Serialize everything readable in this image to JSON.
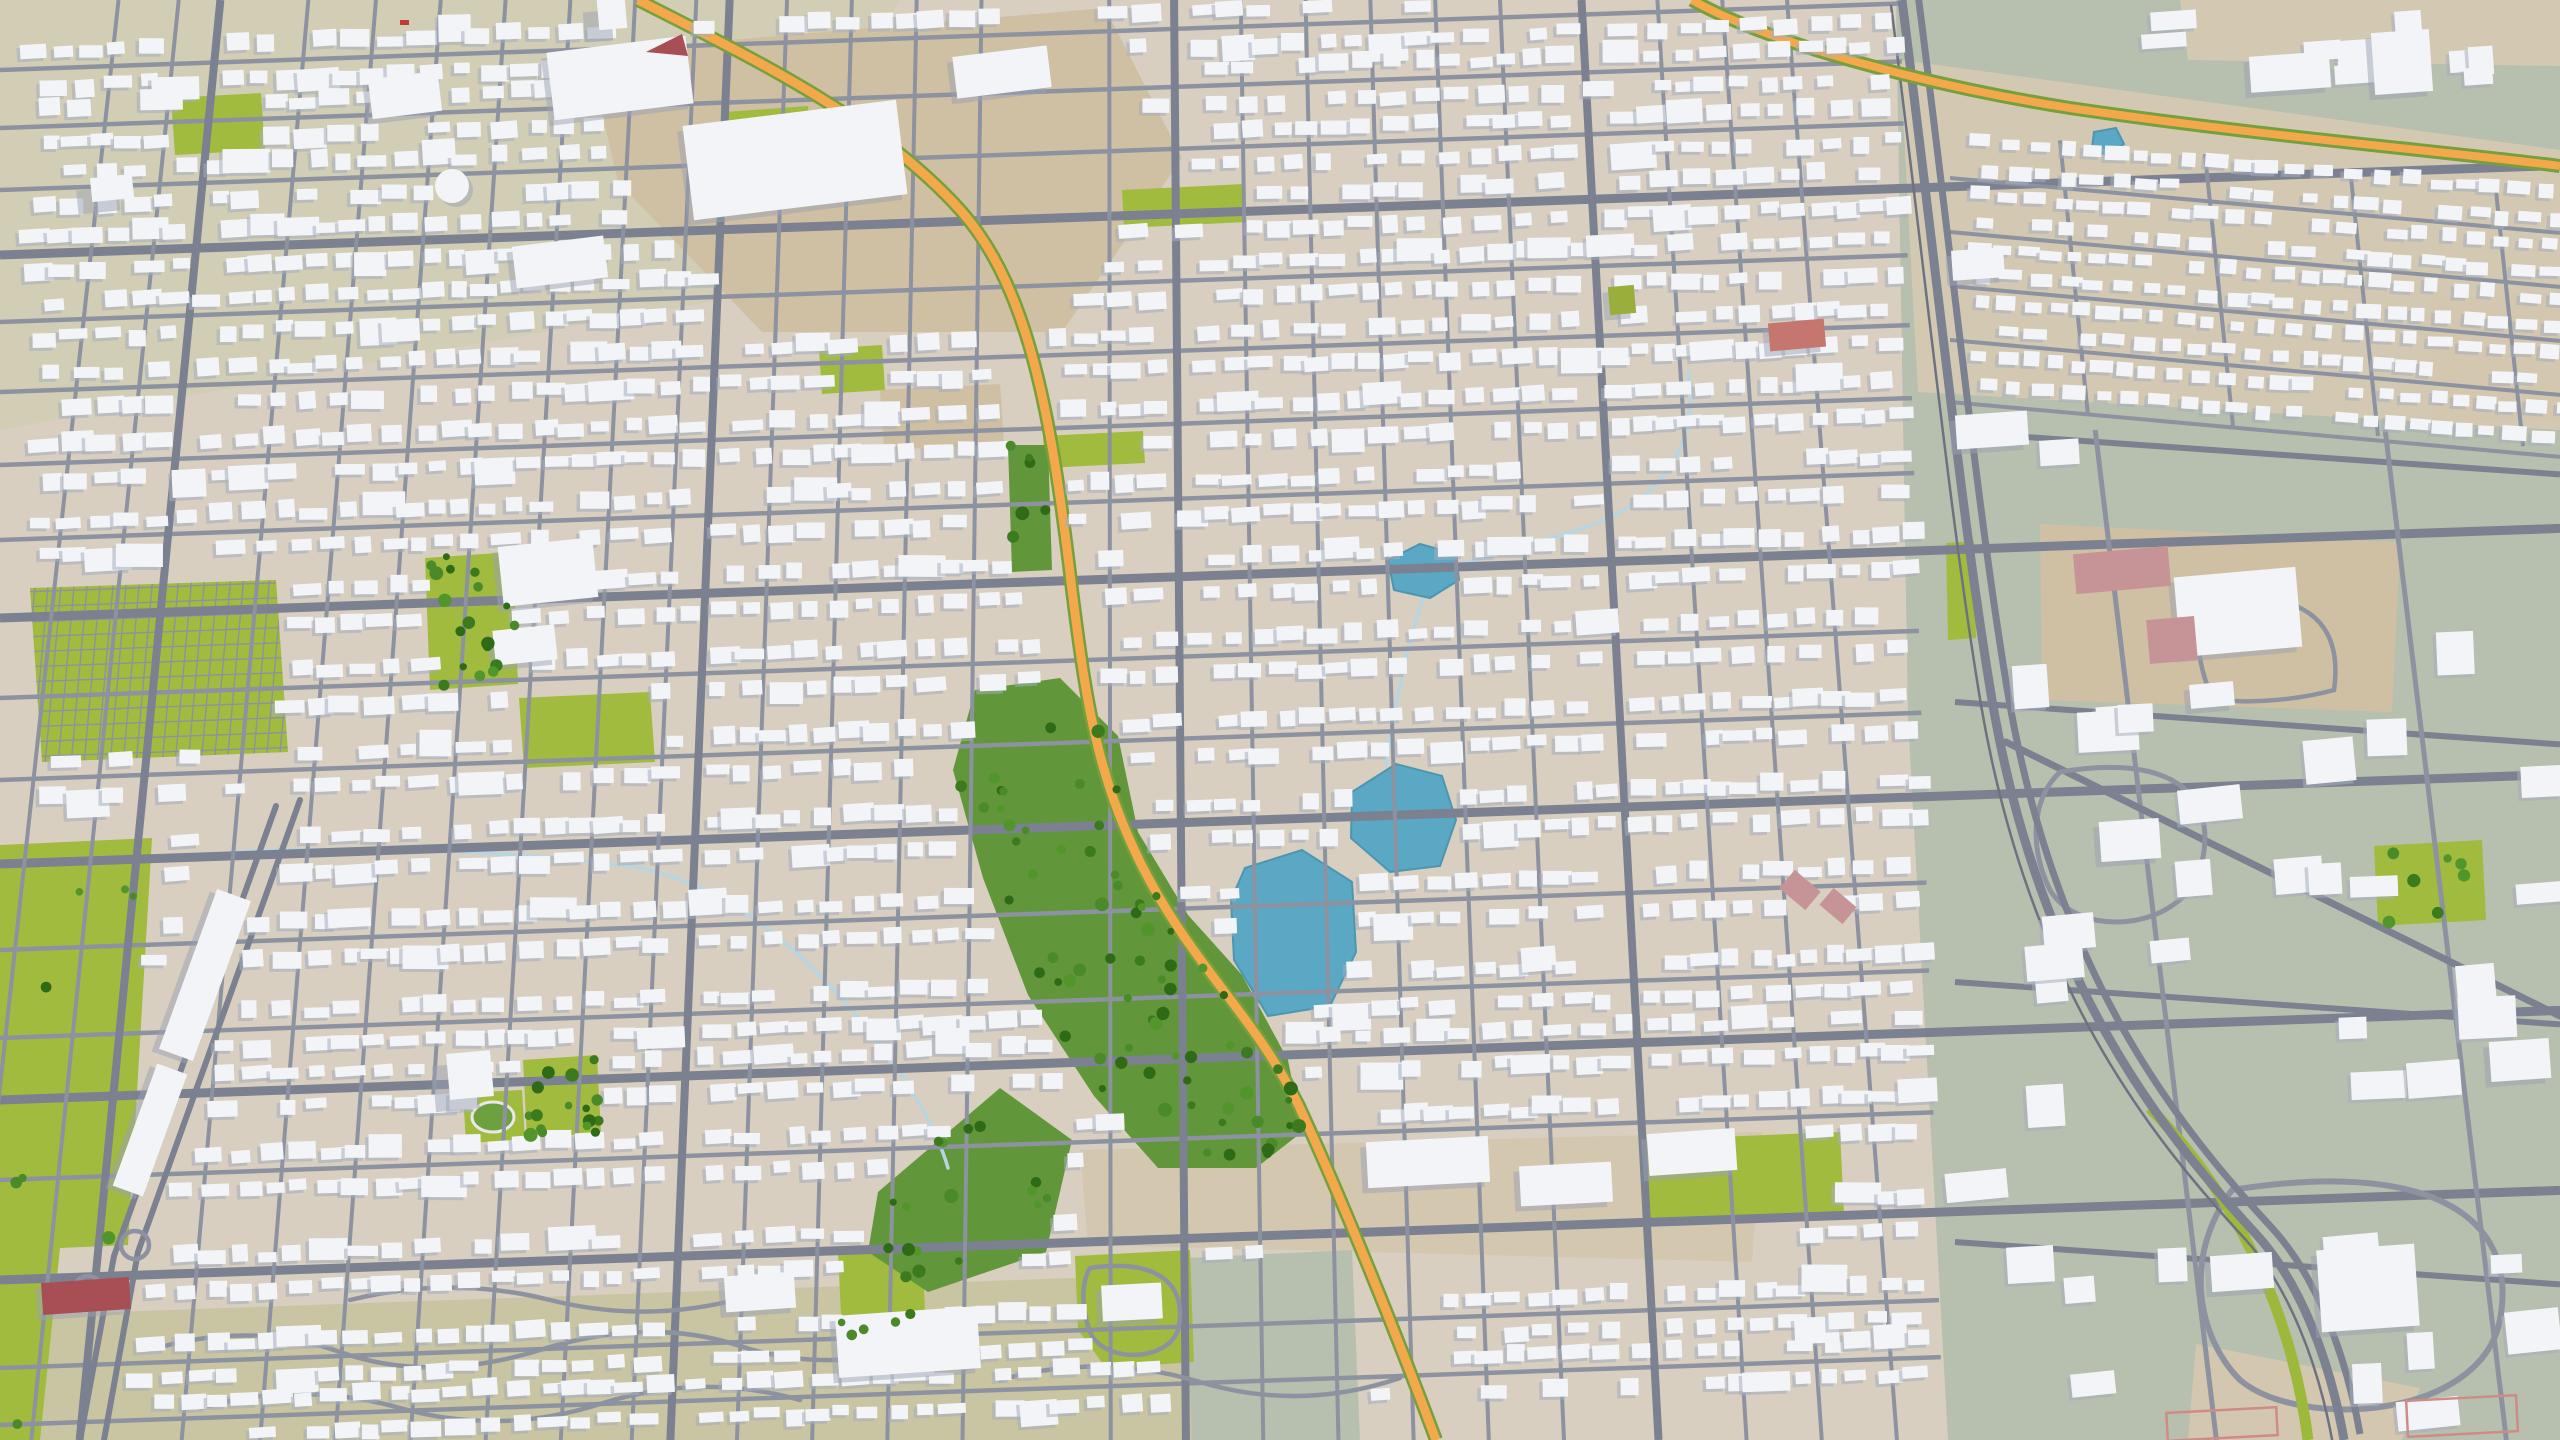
{
  "meta": {
    "description": "Aerial tilted 3D render of a suburban city map: dense white low-poly buildings on tan ground, gray street grid, orange highways, green parks, a central tree-lined greenbelt, blue lakes, and a sage-green open district on the right"
  },
  "palette": {
    "ground": "#d8cfc1",
    "olive_tl": "#d2ceb5",
    "khaki_bottom": "#c9c5a2",
    "dirt": "#cfc0a3",
    "dirt_light": "#d3c7b0",
    "sage": "#b7c0ae",
    "band_tan": "#d3c9b3",
    "lawn": "#a0bb3e",
    "grass_dark": "#61973a",
    "grass_mid": "#6fa03f",
    "lake": "#5aa8c4",
    "lake_edge": "#4d96b1",
    "stream": "#b7d6e2",
    "road_minor": "#8d92a0",
    "road_major": "#7b8190",
    "rail": "#6d7280",
    "highway": "#f3a94b",
    "highway_verge": "#75a03c",
    "median_green": "#9db93c",
    "house_top": "#f2f4f8",
    "house_shadow": "#a6adbb",
    "landmark_shadow": "#9ba2b2",
    "track_lane": "#e8e8ea",
    "red_building": "#a84f56",
    "salmon_building": "#c4766f",
    "olive_building": "#9aae3c",
    "pink_field": "#c69497",
    "pink_outline": "#cf8b85",
    "red_vehicle": "#c23b31"
  },
  "gen": {
    "seed": 7,
    "canvas": {
      "w": 2560,
      "h": 1440
    },
    "vp": {
      "x": 1100,
      "y": -9000
    },
    "ew_slope": -0.035,
    "xend_base": 1898,
    "xend_k": 0.03,
    "house": {
      "step_min": 22,
      "step_rand": 15,
      "w_min": 15,
      "w_rand": 16,
      "h_min": 10,
      "h_rand": 8,
      "off_min": 8,
      "off_rand": 5,
      "big_chance": 0.06,
      "skip_chance": 0.09,
      "rot_base": -2,
      "rot_jitter": 5
    },
    "sage_boxes": {
      "n": 46,
      "x0": 1975,
      "xr": 575,
      "y0": 430,
      "yr": 1000,
      "w_min": 26,
      "w_rand": 42,
      "h_min": 18,
      "h_rand": 26
    },
    "corner_boxes": {
      "n": 9,
      "x0": 2160,
      "xr": 370,
      "y0": 8,
      "yr": 80,
      "w_min": 20,
      "w_rand": 30,
      "h_min": 14,
      "h_rand": 16
    }
  },
  "ground_patches": [
    {
      "name": "olive-top-left",
      "points": "0,0 900,0 720,300 0,430",
      "fill": "olive_tl"
    },
    {
      "name": "khaki-bottom",
      "points": "0,1316 1298,1270 1340,1440 0,1440",
      "fill": "khaki_bottom"
    },
    {
      "name": "sage-district",
      "points": "1896,0 2560,0 2560,1440 1948,1440 1908,720",
      "fill": "sage"
    },
    {
      "name": "tan-band-top-right",
      "points": "1900,60 2560,150 2560,430 1918,392",
      "fill": "band_tan"
    },
    {
      "name": "tan-corner-top-right",
      "points": "2180,0 2560,0 2560,66 2188,60",
      "fill": "band_tan"
    },
    {
      "name": "dirt-industrial-top",
      "points": "588,52 1105,8 1182,158 1062,332 762,332 618,182",
      "fill": "dirt"
    },
    {
      "name": "dirt-campus-right",
      "points": "2040,524 2400,542 2392,712 2042,700",
      "fill": "dirt"
    },
    {
      "name": "dirt-commercial-bottom-center",
      "points": "1080,1150 1762,1132 1752,1262 1285,1250 1088,1245",
      "fill": "dirt_light"
    },
    {
      "name": "dirt-patch-center",
      "points": "880,390 1000,384 1004,444 884,450",
      "fill": "dirt"
    },
    {
      "name": "dirt-bottom-right",
      "points": "2196,1344 2420,1388 2402,1440 2188,1440",
      "fill": "dirt_light"
    },
    {
      "name": "dirt-right-edge",
      "points": "2428,298 2560,292 2560,420 2432,422",
      "fill": "dirt_light"
    },
    {
      "name": "sage-patch-bottom-center",
      "points": "1185,1258 1352,1250 1360,1440 1192,1440",
      "fill": "sage"
    }
  ],
  "parks": [
    {
      "name": "park-small-tl",
      "points": "171,98 261,93 265,150 175,155",
      "mask": true
    },
    {
      "name": "park-top-1",
      "points": "725,112 808,106 812,178 729,184",
      "mask": true
    },
    {
      "name": "park-top-2",
      "points": "1122,190 1244,184 1246,222 1124,228",
      "mask": true
    },
    {
      "name": "park-top-3",
      "points": "819,349 882,345 885,390 822,394",
      "mask": true
    },
    {
      "name": "park-trees-left",
      "points": "425,558 513,552 518,684 430,690",
      "mask": true
    },
    {
      "name": "lawns-bottom-left",
      "points": "0,845 152,838 128,1245 60,1248 40,1440 0,1440",
      "mask": true
    },
    {
      "name": "hospital-lawn",
      "points": "519,698 650,692 655,762 524,768",
      "mask": true
    },
    {
      "name": "park-bc-a",
      "points": "838,1252 922,1248 926,1332 842,1336",
      "mask": true
    },
    {
      "name": "park-bc-b",
      "points": "1075,1256 1190,1250 1194,1362 1106,1368 1078,1330",
      "mask": true
    },
    {
      "name": "lawn-big-building",
      "points": "1646,1140 1840,1132 1844,1212 1650,1220",
      "mask": true
    },
    {
      "name": "green-right-side",
      "points": "2374,846 2482,840 2486,920 2378,926",
      "mask": true
    },
    {
      "name": "park-strip-center",
      "points": "1043,436 1143,431 1145,463 1045,468",
      "mask": true
    },
    {
      "name": "park-trees-bl",
      "points": "523,1060 597,1055 601,1133 527,1138",
      "mask": true
    },
    {
      "name": "track-park",
      "points": "463,1093 522,1090 525,1140 466,1143",
      "mask": true
    },
    {
      "name": "corridor-verge",
      "points": "1946,543 1974,541 1976,638 1948,640",
      "mask": false
    }
  ],
  "greenbelt": [
    {
      "name": "greenbelt-main",
      "points": "975,690 1060,678 1118,736 1138,832 1188,915 1242,975 1288,1060 1302,1132 1256,1168 1158,1168 1094,1096 1028,995 983,878 953,770",
      "mask": true
    },
    {
      "name": "greenbelt-southwest",
      "points": "878,1192 1000,1088 1072,1140 1046,1252 928,1292 868,1252",
      "mask": true
    },
    {
      "name": "greenbelt-north-strip",
      "points": "1008,445 1048,445 1052,570 1012,572",
      "mask": true
    }
  ],
  "cemetery": {
    "name": "cemetery-grid-park",
    "points": "30,588 276,580 288,752 42,762",
    "mask": true
  },
  "lakes": [
    {
      "name": "lake-large",
      "points": "1245,868 1302,850 1352,882 1356,952 1330,1006 1268,1016 1234,960 1231,900",
      "mask": true
    },
    {
      "name": "lake-upper",
      "points": "1352,792 1396,764 1442,776 1456,820 1440,866 1390,872 1351,838",
      "mask": true
    },
    {
      "name": "lake-small-north",
      "points": "1388,560 1420,544 1456,554 1459,580 1430,598 1394,590",
      "mask": true
    },
    {
      "name": "pond-top-right",
      "points": "2094,132 2116,128 2124,144 2108,156 2092,148",
      "mask": false
    }
  ],
  "streams": [
    {
      "name": "creek-west",
      "d": "M230,852 C360,846 520,850 640,868 C760,892 850,1000 905,1080 C925,1112 940,1140 948,1168"
    },
    {
      "name": "creek-northeast",
      "d": "M1688,372 C1700,430 1672,492 1600,522 C1550,540 1490,556 1452,566"
    },
    {
      "name": "creek-lake-link",
      "d": "M1424,596 C1408,640 1396,700 1386,764"
    }
  ],
  "masks_extra": [
    {
      "name": "highway-corridor-band",
      "points": "618,0 702,42 962,198 1042,322 1082,560 1112,722 1172,880 1262,1020 1342,1152 1442,1332 1500,1440 1418,1440 1268,1162 1178,982 1078,800 1040,622 998,382 918,242 658,62 578,0"
    },
    {
      "name": "boulevard-band",
      "points": "292,798 222,796 70,1238 18,1440 122,1440 164,1240"
    }
  ],
  "roads": {
    "ew_minor_y": [
      70,
      128,
      190,
      322,
      392,
      465,
      540,
      698,
      780,
      950,
      1038,
      1180,
      1368,
      1425
    ],
    "ew_major_y": [
      255,
      618,
      864,
      1100,
      1280
    ],
    "ns_minor_x": [
      40,
      105,
      245,
      318,
      388,
      458,
      528,
      598,
      664,
      762,
      832,
      902,
      972,
      1110,
      1252,
      1322,
      1392,
      1462,
      1532,
      1702,
      1772,
      1842
    ],
    "ns_major_x": [
      150,
      700,
      1180,
      1620
    ],
    "sage_ew_y": [
      432,
      702,
      982,
      1242
    ],
    "sage_ew_slope": 0.07,
    "band_ew_y": [
      178,
      232,
      286,
      340,
      402
    ],
    "band_ew_slope": 0.09,
    "band_ns_x": [
      2060,
      2205,
      2350,
      2495
    ],
    "house_rows_y": [
      70,
      128,
      190,
      255,
      322,
      392,
      465,
      540,
      618,
      698,
      780,
      864,
      950,
      1038,
      1100,
      1180,
      1280,
      1368,
      1425
    ],
    "band_house_rows_y": [
      152,
      205,
      258,
      312,
      368
    ],
    "explicit": [
      {
        "name": "boulevard-lane-1",
        "d": "M300,800 L138,1252 L104,1440",
        "stroke": "road_major",
        "w": 6
      },
      {
        "name": "boulevard-lane-2",
        "d": "M276,806 L114,1256 L80,1440",
        "stroke": "road_major",
        "w": 6
      },
      {
        "name": "sage-diagonal-road",
        "d": "M2006,742 L2560,1016",
        "stroke": "road_major",
        "w": 7
      },
      {
        "name": "sage-loop-mall",
        "d": "M2232,1190 C2420,1160 2520,1210 2500,1320 C2480,1420 2300,1430 2240,1380 C2200,1340 2180,1260 2232,1190",
        "stroke": "road_minor",
        "w": 6
      },
      {
        "name": "sage-loop-mid",
        "d": "M2060,772 C2180,752 2220,800 2200,870 C2180,930 2080,940 2050,890 C2030,850 2030,800 2060,772",
        "stroke": "road_minor",
        "w": 5
      },
      {
        "name": "campus-loop",
        "d": "M2210,600 C2300,588 2344,618 2334,690 C2290,702 2236,704 2212,698 C2196,660 2192,618 2210,600",
        "stroke": "road_minor",
        "w": 4.5
      },
      {
        "name": "curvy-bottom-1",
        "d": "M150,1350 Q250,1320 340,1352 T540,1350 T740,1346 T940,1342",
        "stroke": "road_minor",
        "w": 4.5
      },
      {
        "name": "curvy-bottom-2",
        "d": "M200,1408 Q300,1380 400,1408 T600,1404 T800,1400",
        "stroke": "road_minor",
        "w": 4.5
      },
      {
        "name": "curvy-bottom-3",
        "d": "M1000,1380 Q1100,1352 1200,1382 T1400,1378",
        "stroke": "road_minor",
        "w": 4.5
      },
      {
        "name": "curvy-bottom-4",
        "d": "M350,1300 Q450,1275 550,1300 T750,1296",
        "stroke": "road_minor",
        "w": 4.5
      },
      {
        "name": "park-bc-loop",
        "d": "M1090,1268 C1160,1258 1188,1286 1178,1330 C1168,1360 1110,1364 1092,1336 C1082,1314 1080,1284 1090,1268",
        "stroke": "road_minor",
        "w": 4.5
      }
    ],
    "interchange_circles": [
      {
        "name": "ramp-loop-1",
        "cx": 88,
        "cy": 1290,
        "r": 14
      },
      {
        "name": "ramp-loop-2",
        "cx": 135,
        "cy": 1245,
        "r": 14
      }
    ]
  },
  "corridor": {
    "main_d": "M1902,0 C1940,300 1962,520 1992,700 C2040,980 2160,1130 2256,1234 C2300,1282 2330,1360 2344,1440",
    "pts": "1902,0 1992,700 2256,1234 2344,1440",
    "median_d": "M2150,1108 C2230,1190 2290,1300 2308,1440"
  },
  "highways": {
    "main": {
      "name": "highway-main",
      "d": "M638,0 C760,62 880,120 962,212 C1030,290 1052,420 1072,590 C1086,700 1096,772 1140,862 C1192,966 1252,1012 1298,1104 C1338,1190 1392,1322 1436,1440"
    },
    "top_right": {
      "name": "highway-top-right",
      "d": "M1692,0 C1770,44 1930,86 2070,108 C2260,136 2452,152 2560,166",
      "pts": "1692,0 2070,108 2560,166"
    }
  },
  "landmarks": [
    {
      "name": "factory-1",
      "x": 620,
      "y": 78,
      "w": 140,
      "h": 68,
      "r": -7
    },
    {
      "name": "factory-large",
      "x": 795,
      "y": 160,
      "w": 215,
      "h": 95,
      "r": -7
    },
    {
      "name": "factory-2",
      "x": 1002,
      "y": 72,
      "w": 95,
      "h": 42,
      "r": -7
    },
    {
      "name": "warehouse-top",
      "x": 560,
      "y": 262,
      "w": 92,
      "h": 42,
      "r": -7
    },
    {
      "name": "bigbox-top-left",
      "x": 405,
      "y": 95,
      "w": 70,
      "h": 40,
      "r": -7
    },
    {
      "name": "tower-top-left",
      "x": 612,
      "y": 14,
      "w": 28,
      "h": 30,
      "r": -5,
      "tall": true
    },
    {
      "name": "block-top-left-corner",
      "x": 112,
      "y": 188,
      "w": 42,
      "h": 24,
      "r": -6,
      "tall": true
    },
    {
      "name": "hospital-main",
      "x": 548,
      "y": 572,
      "w": 95,
      "h": 60,
      "r": -6
    },
    {
      "name": "hospital-annex",
      "x": 525,
      "y": 645,
      "w": 62,
      "h": 35,
      "r": -6
    },
    {
      "name": "apartment-tower-bl",
      "x": 470,
      "y": 1075,
      "w": 44,
      "h": 46,
      "r": -5,
      "tall": true
    },
    {
      "name": "strip-mall-1",
      "x": 205,
      "y": 975,
      "w": 36,
      "h": 170,
      "r": 20
    },
    {
      "name": "strip-mall-2",
      "x": 150,
      "y": 1130,
      "w": 32,
      "h": 130,
      "r": 20
    },
    {
      "name": "school-right",
      "x": 2238,
      "y": 612,
      "w": 122,
      "h": 80,
      "r": -5
    },
    {
      "name": "school-annex",
      "x": 2212,
      "y": 695,
      "w": 44,
      "h": 24,
      "r": -5
    },
    {
      "name": "mall-bottom-right",
      "x": 2368,
      "y": 1288,
      "w": 98,
      "h": 82,
      "r": -4
    },
    {
      "name": "office-bottom-right",
      "x": 2242,
      "y": 1272,
      "w": 62,
      "h": 36,
      "r": -4
    },
    {
      "name": "bigbox-lawn-center",
      "x": 1692,
      "y": 1152,
      "w": 88,
      "h": 42,
      "r": -4
    },
    {
      "name": "retail-strip-1",
      "x": 1428,
      "y": 1162,
      "w": 122,
      "h": 46,
      "r": -3
    },
    {
      "name": "retail-strip-2",
      "x": 1566,
      "y": 1184,
      "w": 92,
      "h": 40,
      "r": -3
    },
    {
      "name": "factory-bottom-center",
      "x": 908,
      "y": 1342,
      "w": 142,
      "h": 62,
      "r": -4
    },
    {
      "name": "warehouse-bottom-center",
      "x": 760,
      "y": 1292,
      "w": 70,
      "h": 36,
      "r": -4
    },
    {
      "name": "community-bldg-park-bc",
      "x": 1132,
      "y": 1302,
      "w": 60,
      "h": 36,
      "r": -3
    },
    {
      "name": "salmon-building-right",
      "x": 1797,
      "y": 335,
      "w": 56,
      "h": 28,
      "r": -5,
      "fill": "salmon_building"
    },
    {
      "name": "red-building-bottom-left",
      "x": 86,
      "y": 1296,
      "w": 88,
      "h": 32,
      "r": -4,
      "fill": "red_building"
    },
    {
      "name": "olive-building-right",
      "x": 1622,
      "y": 300,
      "w": 26,
      "h": 28,
      "r": -5,
      "fill": "olive_building"
    },
    {
      "name": "depot-right-1",
      "x": 1992,
      "y": 430,
      "w": 72,
      "h": 34,
      "r": -4
    },
    {
      "name": "depot-right-2",
      "x": 1978,
      "y": 264,
      "w": 52,
      "h": 30,
      "r": -4
    },
    {
      "name": "plant-top-right",
      "x": 2402,
      "y": 62,
      "w": 58,
      "h": 62,
      "r": -4
    },
    {
      "name": "office-right-edge",
      "x": 2520,
      "y": 1060,
      "w": 60,
      "h": 40,
      "r": -4
    },
    {
      "name": "bldg-loop-mid",
      "x": 2130,
      "y": 840,
      "w": 60,
      "h": 40,
      "r": -4
    },
    {
      "name": "bigbox-corner-tr",
      "x": 2290,
      "y": 72,
      "w": 80,
      "h": 36,
      "r": -4
    }
  ],
  "special_shapes": [
    {
      "name": "storage-tank",
      "type": "circle",
      "cx": 452,
      "cy": 186,
      "r": 17
    },
    {
      "name": "red-triangle-building",
      "type": "poly",
      "points": "646,52 688,56 682,34",
      "fill": "red_building"
    },
    {
      "name": "red-vehicle",
      "type": "rect",
      "x": 400,
      "y": 20,
      "w": 9,
      "h": 5,
      "fill": "red_vehicle"
    }
  ],
  "pink_fields": [
    {
      "name": "ballfield-right-1",
      "x": 2122,
      "y": 570,
      "w": 95,
      "h": 40,
      "r": -5
    },
    {
      "name": "ballfield-right-2",
      "x": 2172,
      "y": 640,
      "w": 48,
      "h": 44,
      "r": -5
    },
    {
      "name": "ballfield-center-1",
      "x": 1800,
      "y": 890,
      "w": 34,
      "h": 24,
      "r": 40
    },
    {
      "name": "ballfield-center-2",
      "x": 1838,
      "y": 906,
      "w": 30,
      "h": 22,
      "r": 40
    }
  ],
  "outlined_fields": [
    {
      "name": "field-outline-br-1",
      "x": 2462,
      "y": 1416,
      "w": 110,
      "h": 36,
      "r": -3
    },
    {
      "name": "field-outline-br-2",
      "x": 2222,
      "y": 1424,
      "w": 110,
      "h": 28,
      "r": -3
    }
  ],
  "track": {
    "name": "running-track",
    "cx": 493,
    "cy": 1117,
    "rx": 21,
    "ry": 15
  },
  "trees": [
    {
      "in": "greenbelt-main",
      "n": 70
    },
    {
      "in": "greenbelt-southwest",
      "n": 16
    },
    {
      "in": "greenbelt-north-strip",
      "n": 6
    },
    {
      "in": "park-trees-left",
      "n": 18
    },
    {
      "in": "park-trees-bl",
      "n": 16
    },
    {
      "in": "park-bc-a",
      "n": 6
    },
    {
      "in": "green-right-side",
      "n": 7
    },
    {
      "in": "lawns-bottom-left",
      "n": 8
    }
  ]
}
